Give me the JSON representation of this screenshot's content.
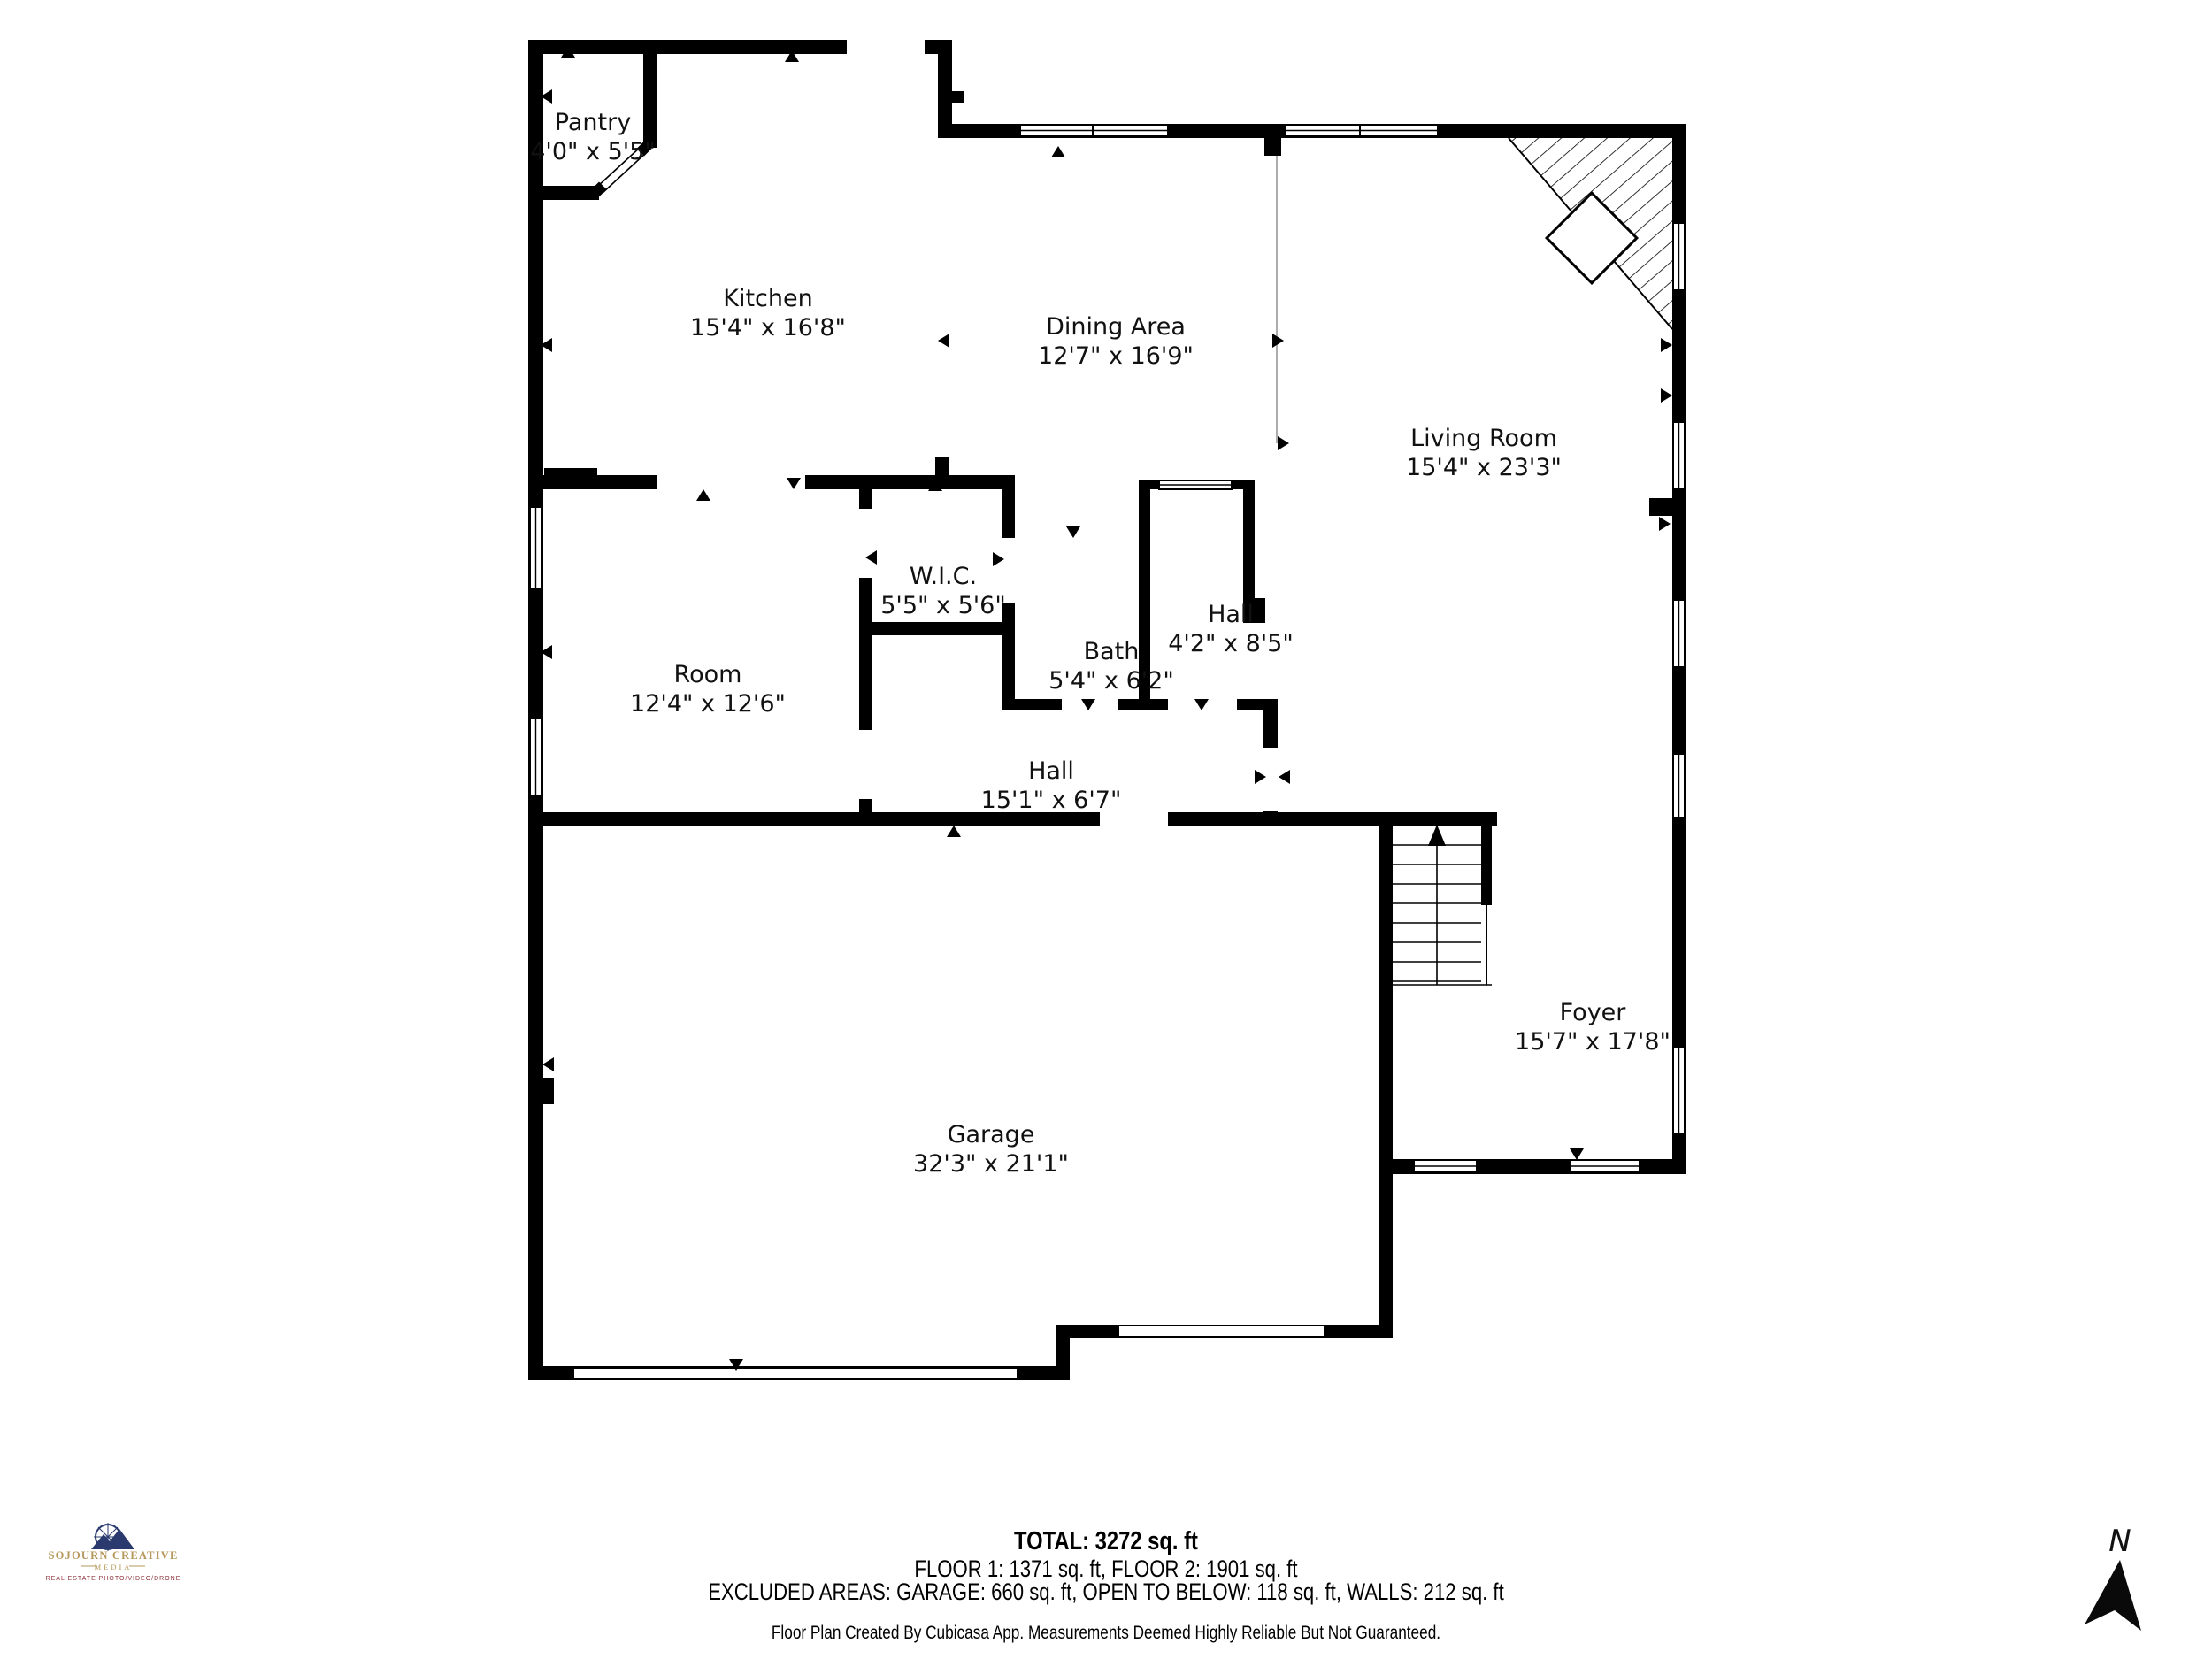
{
  "rooms": [
    {
      "name": "Pantry",
      "dims": "4'0\" x 5'5\""
    },
    {
      "name": "Kitchen",
      "dims": "15'4\" x 16'8\""
    },
    {
      "name": "Dining Area",
      "dims": "12'7\" x 16'9\""
    },
    {
      "name": "Living Room",
      "dims": "15'4\" x 23'3\""
    },
    {
      "name": "W.I.C.",
      "dims": "5'5\" x 5'6\""
    },
    {
      "name": "Bath",
      "dims": "5'4\" x 6'2\""
    },
    {
      "name": "Hall",
      "dims": "4'2\" x 8'5\""
    },
    {
      "name": "Room",
      "dims": "12'4\" x 12'6\""
    },
    {
      "name": "Hall",
      "dims": "15'1\" x 6'7\""
    },
    {
      "name": "Garage",
      "dims": "32'3\" x 21'1\""
    },
    {
      "name": "Foyer",
      "dims": "15'7\" x 17'8\""
    }
  ],
  "footer": {
    "total": "TOTAL: 3272 sq. ft",
    "floors": "FLOOR 1: 1371 sq. ft, FLOOR 2: 1901 sq. ft",
    "excluded": "EXCLUDED AREAS: GARAGE: 660 sq. ft, OPEN TO BELOW: 118 sq. ft, WALLS: 212 sq. ft",
    "disclaimer": "Floor Plan Created By Cubicasa App. Measurements Deemed Highly Reliable But Not Guaranteed."
  },
  "compass": {
    "north_label": "N"
  },
  "logo": {
    "line1": "SOJOURN CREATIVE",
    "line2": "MEDIA",
    "line3": "REAL ESTATE PHOTO/VIDEO/DRONE"
  },
  "colors": {
    "wall": "#000000",
    "logo_navy": "#2a3a6e",
    "logo_gold": "#b4975a",
    "logo_red": "#8e3039"
  }
}
